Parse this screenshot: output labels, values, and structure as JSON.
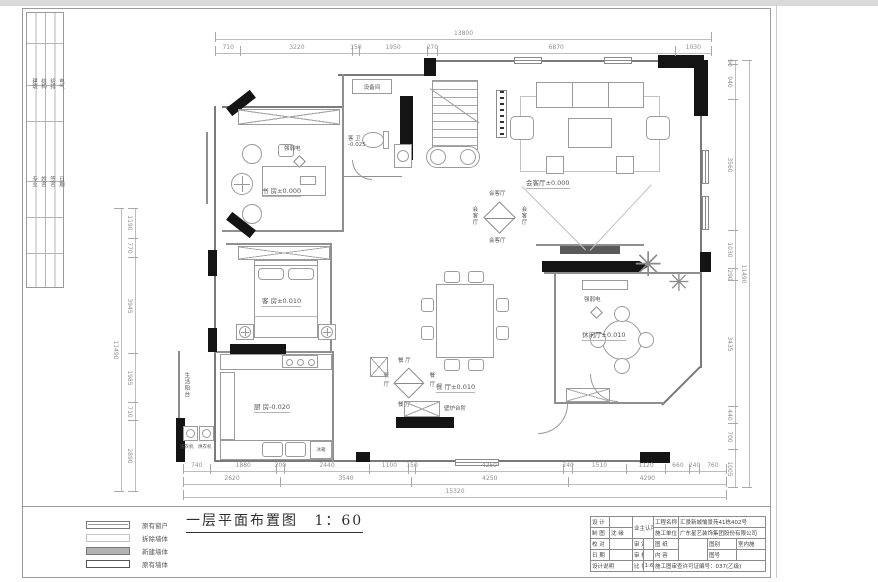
{
  "frame": {
    "title_text": "一层平面布置图",
    "title_scale": "1：60"
  },
  "rooms": {
    "study": "书 房±0.000",
    "living": "会客厅±0.000",
    "bath_line1": "客 卫",
    "bath_line2": "-0.025",
    "guest": "客 房±0.010",
    "kitchen": "厨 房-0.020",
    "dining": "餐 厅±0.010",
    "leisure": "休闲厅±0.010",
    "equipment": "设备间"
  },
  "misc": {
    "fridge": "冰箱",
    "fireplace": "壁炉台阶",
    "washer": "洗衣机",
    "dryer": "烘衣机",
    "balcony": "生活阳台",
    "low_voltage": "强弱电"
  },
  "elev": {
    "living": [
      "会客厅",
      "会客厅",
      "会客厅",
      "会客厅"
    ],
    "dining": [
      "餐 厅",
      "餐 厅",
      "餐 厅",
      "餐 厅"
    ]
  },
  "dims": {
    "top_total": [
      "13800"
    ],
    "top": [
      "710",
      "3220",
      "150",
      "1950",
      "270",
      "6870",
      "1030"
    ],
    "bottom1": [
      "740",
      "1880",
      "200",
      "2440",
      "1100",
      "150",
      "4250",
      "240",
      "1510",
      "1120",
      "660",
      "240",
      "760"
    ],
    "bottom2": [
      "2620",
      "3540",
      "4250",
      "4290"
    ],
    "bottom3": [
      "15320"
    ],
    "left_total": [
      "11490"
    ],
    "left": [
      "1190",
      "770",
      "3945",
      "1985",
      "710",
      "2890"
    ],
    "right_total": [
      "11490"
    ],
    "right": [
      "90",
      "940",
      "3560",
      "1030",
      "290",
      "3435",
      "440",
      "700",
      "1005"
    ]
  },
  "legend": {
    "items": [
      "原有窗户",
      "拆除墙体",
      "新建墙体",
      "原有墙体"
    ]
  },
  "binding": {
    "group1": [
      "建筑",
      "结构",
      "给排",
      "电气"
    ],
    "group2": [
      "专业",
      "姓名",
      "签名",
      "日期"
    ]
  },
  "titleblock": {
    "design_label": "设 计",
    "draft_label": "制 图",
    "draft_value": "沈 缘",
    "check_label": "校 对",
    "date_label": "日 期",
    "notes_label": "设计说明",
    "owner_label": "业主认可",
    "approve_label": "审 定",
    "review_label": "审 核",
    "scale_label": "比 例",
    "scale_value": "1:60",
    "project_label": "工程名称",
    "project_value": "汇景新城愉景苑41栋402号",
    "builder_label": "施工单位",
    "builder_value": "广东星艺装饰集团股份有限公司",
    "sheet_label": "图 纸",
    "content_label": "内 容",
    "type_label": "图别",
    "type_value": "室内施",
    "no_label": "图号",
    "permit": "施工图审查许可证编号：037(乙级)"
  }
}
